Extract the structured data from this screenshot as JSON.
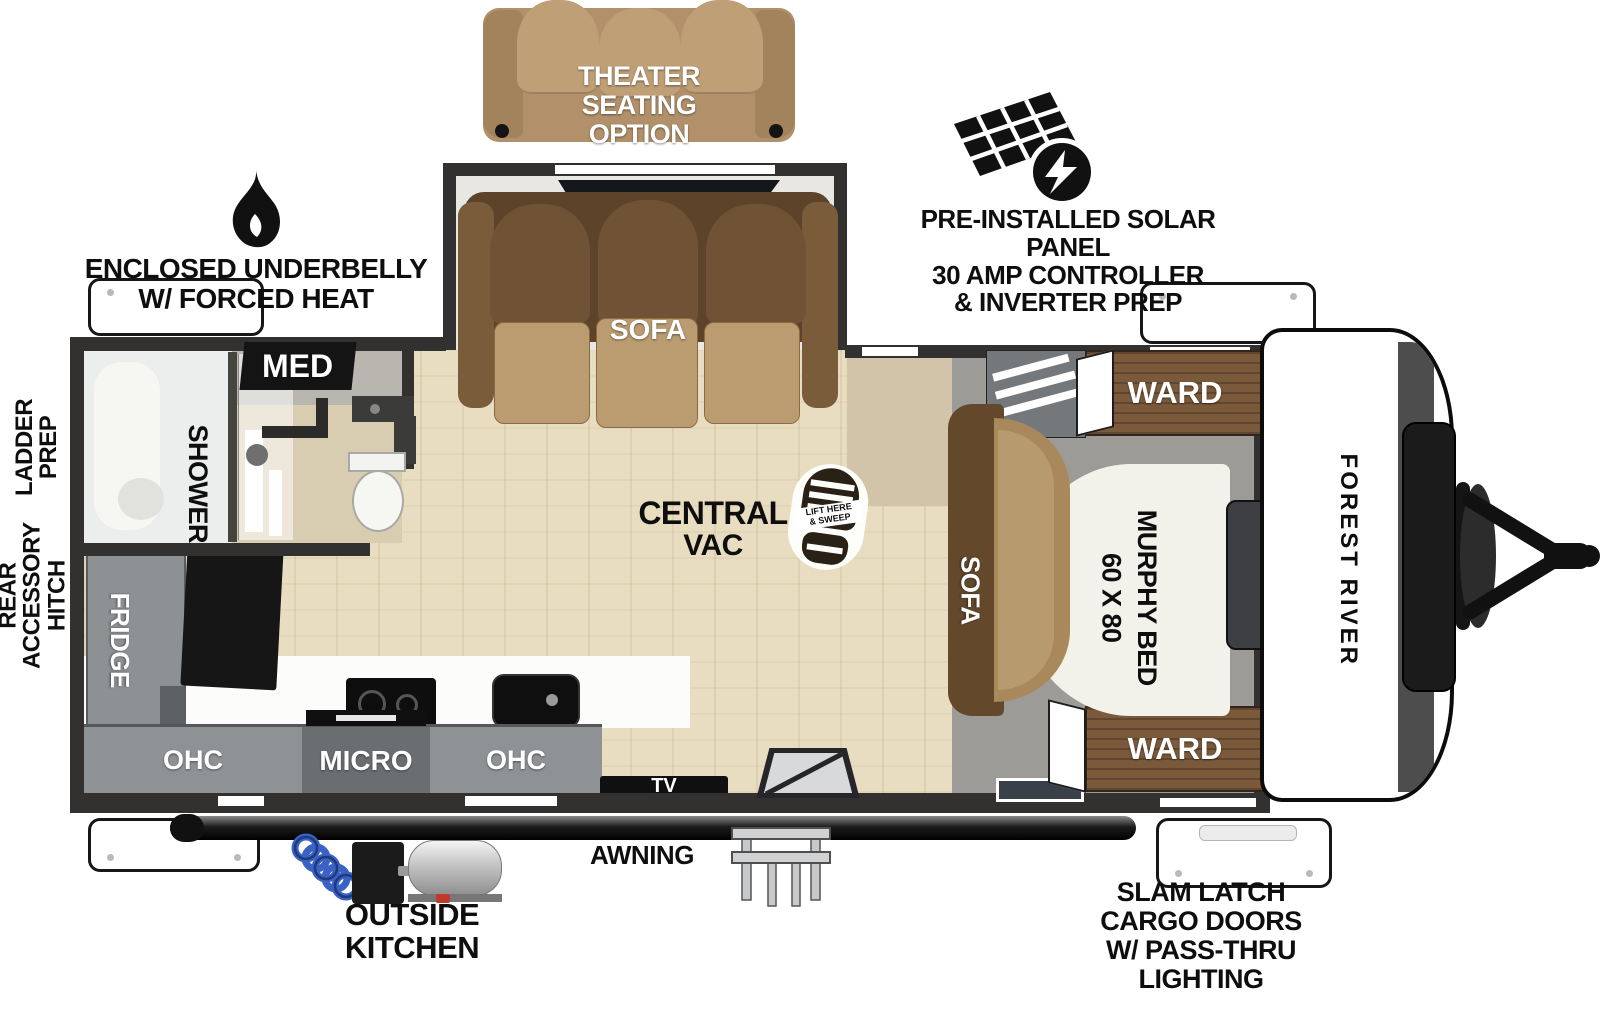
{
  "brand": "FOREST RIVER",
  "annotations": {
    "theater_option": [
      "THEATER",
      "SEATING",
      "OPTION"
    ],
    "solar": [
      "PRE-INSTALLED SOLAR PANEL",
      "30 AMP CONTROLLER",
      "& INVERTER PREP"
    ],
    "underbelly": [
      "ENCLOSED UNDERBELLY",
      "W/ FORCED HEAT"
    ],
    "ladder_prep": [
      "LADDER",
      "PREP"
    ],
    "rear_accessory_hitch": [
      "REAR",
      "ACCESSORY",
      "HITCH"
    ],
    "awning": "AWNING",
    "outside_kitchen": [
      "OUTSIDE",
      "KITCHEN"
    ],
    "slam_latch": [
      "SLAM LATCH",
      "CARGO DOORS",
      "W/ PASS-THRU",
      "LIGHTING"
    ]
  },
  "rooms": {
    "living": {
      "slideout_sofa": "SOFA",
      "central_vac": [
        "CENTRAL",
        "VAC"
      ],
      "vac_sticker": [
        "LIFT HERE",
        "& SWEEP"
      ],
      "tv": "TV"
    },
    "kitchen": {
      "fridge": "FRIDGE",
      "ohc_left": "OHC",
      "micro": "MICRO",
      "ohc_right": "OHC"
    },
    "bathroom": {
      "med": "MED",
      "shower": "SHOWER"
    },
    "bedroom": {
      "ward_top": "WARD",
      "ward_bottom": "WARD",
      "sofa": "SOFA",
      "bed_name": "MURPHY BED",
      "bed_size": "60 X 80"
    }
  },
  "colors": {
    "wall": "#32312f",
    "floor_wood": "#e9ddc1",
    "floor_bedroom": "#9c9b97",
    "cabinet_gray": "#8f9294",
    "micro_gray": "#6b6e71",
    "sofa_brown": "#a9895c",
    "sofa_back_brown": "#5c432a",
    "ward_wood": "#7b5a3c",
    "hose_blue": "#3a62c4",
    "annotation_black": "#0e0e0e"
  }
}
